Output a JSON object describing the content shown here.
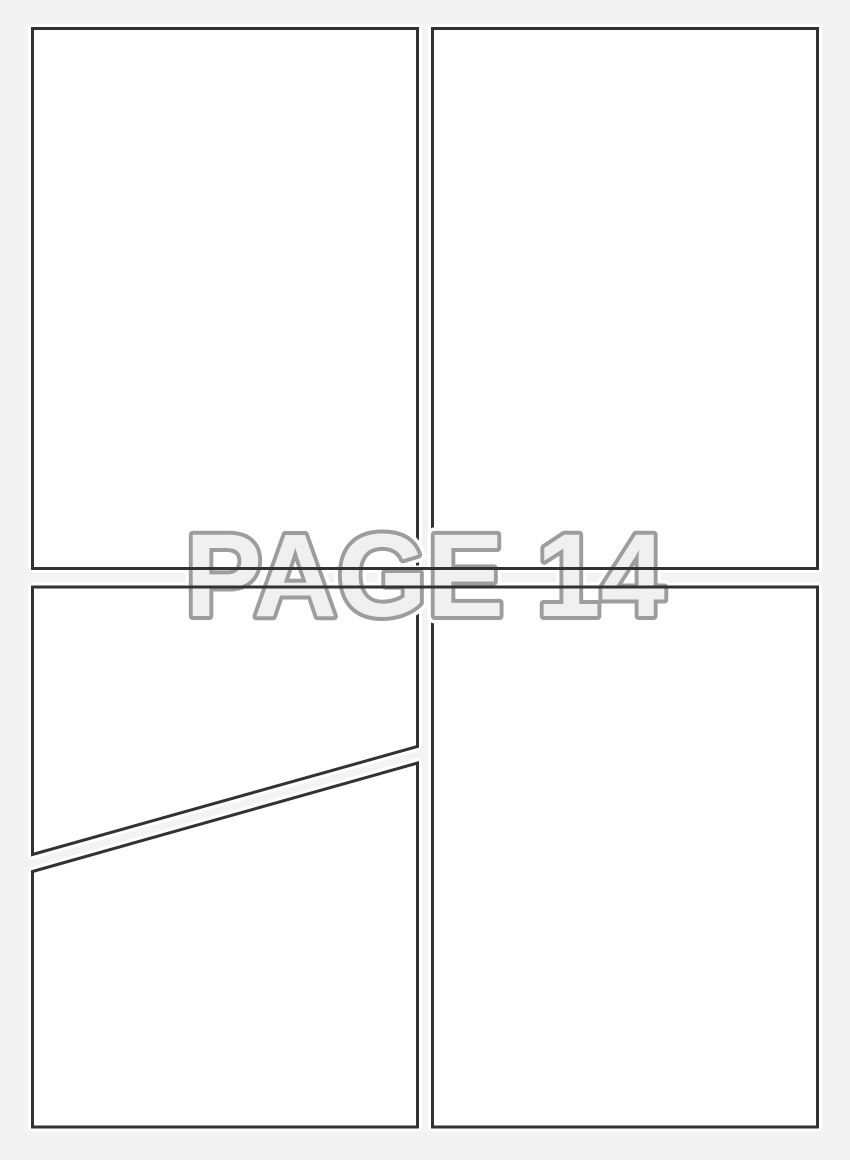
{
  "template": {
    "watermark_text": "PAGE 14",
    "colors": {
      "background": "#f3f3f4",
      "panel_fill": "#ffffff",
      "panel_halo": "#ffffff",
      "panel_border": "#323232",
      "watermark_fill": "#f0f0f0",
      "watermark_outline": "#9d9d9d",
      "watermark_halo": "#ffffff"
    }
  }
}
